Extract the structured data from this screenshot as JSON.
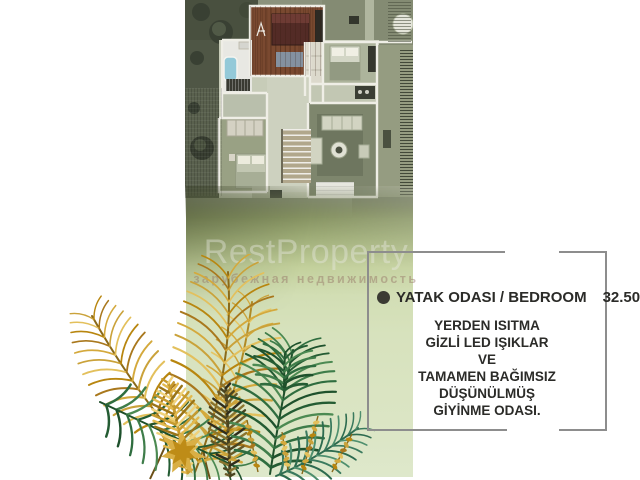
{
  "watermark": {
    "brand": "RestProperty",
    "tagline": "зарубежная недвижимость"
  },
  "info_box": {
    "title": "YATAK ODASI / BEDROOM",
    "area": "32.50 m",
    "area_sup": "2",
    "features": [
      "YERDEN ISITMA",
      "GİZLİ LED IŞIKLAR",
      "VE",
      "TAMAMEN BAĞIMSIZ DÜŞÜNÜLMÜŞ",
      "GİYİNME ODASI."
    ]
  },
  "colors": {
    "band_top": "#6b7452",
    "band_bottom": "#dee8cb",
    "box_border": "#8d8d8d",
    "text": "#2b2b28",
    "bullet": "#3b3b33",
    "gold": [
      "#b8860f",
      "#d4a93c",
      "#e3c05c",
      "#a9781d",
      "#caa23a"
    ],
    "gold_light": [
      "#e6c663",
      "#d4a93c",
      "#caa23a"
    ],
    "green": [
      "#2f6d3f",
      "#245c33",
      "#3f7d4a",
      "#1e512c",
      "#4c8a52"
    ],
    "teal": [
      "#3a7a5e",
      "#2d6b4f",
      "#4e8f6e"
    ],
    "bronze": [
      "#6b5a28",
      "#4a4420",
      "#8a742e",
      "#2f2d1d",
      "#caa23a"
    ],
    "gold_feather": [
      "#e2b94e",
      "#c69a2e",
      "#f0d27a",
      "#9a7418"
    ]
  }
}
